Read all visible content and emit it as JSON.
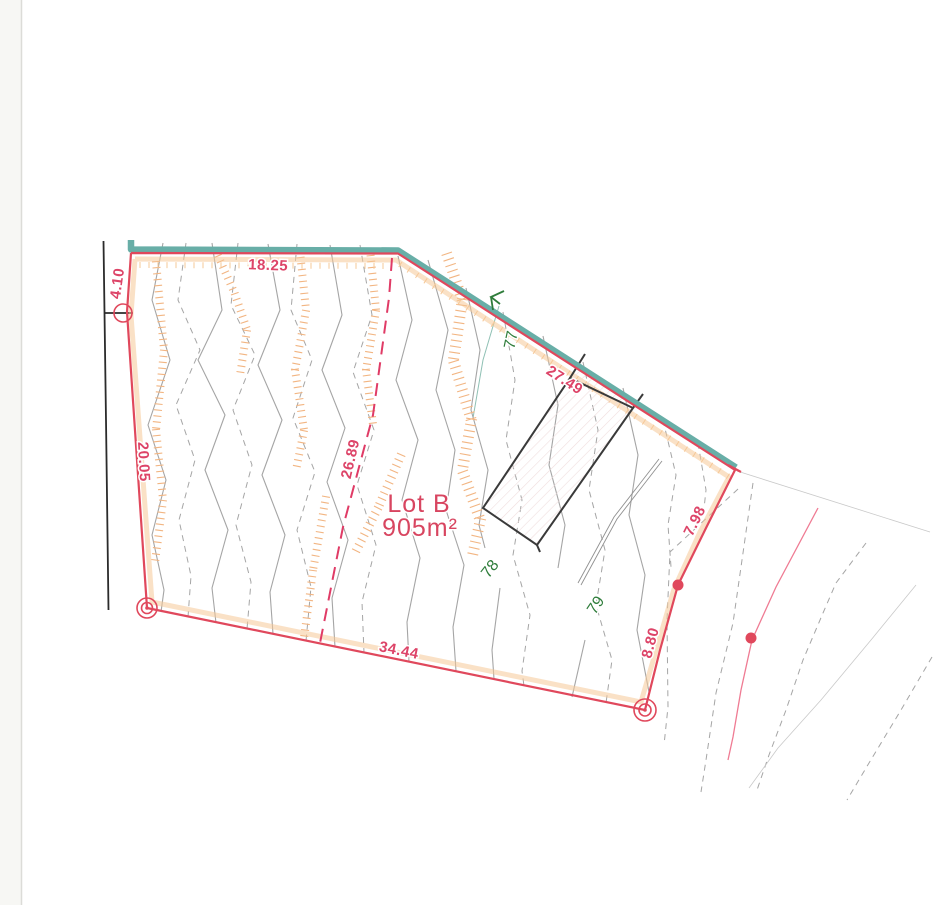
{
  "plan": {
    "lot": {
      "name": "Lot B",
      "area": "905m²"
    },
    "dimensions": {
      "top": "18.25",
      "top_left": "4.10",
      "left": "20.05",
      "division": "26.89",
      "top_right": "27.49",
      "bottom": "34.44",
      "right_upper": "7.98",
      "right_lower": "8.80"
    },
    "contour_labels": {
      "c77": "77",
      "c78": "78",
      "c79": "79"
    },
    "colors": {
      "boundary-red": "#e0485c",
      "dimension-red": "#dd4468",
      "division-red": "#e03b66",
      "lot-red": "#d84560",
      "teal": "#68aea7",
      "hatch-orange": "#f2b582",
      "stripe-orange": "#f6c897",
      "contour-green": "#2f7d3b",
      "contour-gray": "#a5a5a5",
      "black-line": "#2b2b2b",
      "pink-line": "#ef7b93"
    }
  }
}
